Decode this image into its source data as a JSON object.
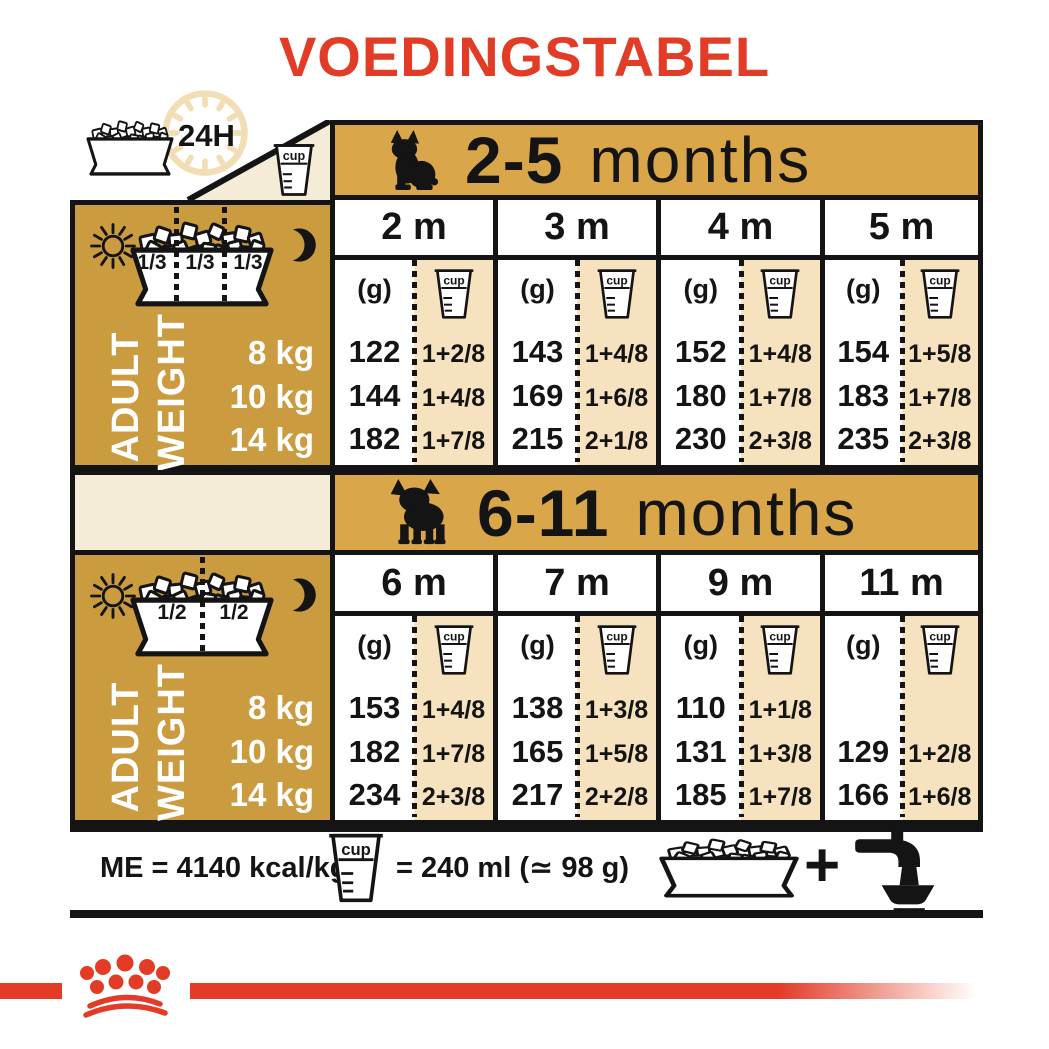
{
  "title": "VOEDINGSTABEL",
  "legend": {
    "hours": "24H"
  },
  "cup_label": "cup",
  "tables": [
    {
      "age": "2-5",
      "months_word": "months",
      "portions": [
        "1/3",
        "1/3",
        "1/3"
      ],
      "weight_label": [
        "ADULT",
        "WEIGHT"
      ],
      "weights": [
        "8 kg",
        "10 kg",
        "14 kg"
      ],
      "unit_g": "(g)",
      "columns": [
        {
          "month": "2 m",
          "grams": [
            "122",
            "144",
            "182"
          ],
          "cups": [
            "1+2/8",
            "1+4/8",
            "1+7/8"
          ]
        },
        {
          "month": "3 m",
          "grams": [
            "143",
            "169",
            "215"
          ],
          "cups": [
            "1+4/8",
            "1+6/8",
            "2+1/8"
          ]
        },
        {
          "month": "4 m",
          "grams": [
            "152",
            "180",
            "230"
          ],
          "cups": [
            "1+4/8",
            "1+7/8",
            "2+3/8"
          ]
        },
        {
          "month": "5 m",
          "grams": [
            "154",
            "183",
            "235"
          ],
          "cups": [
            "1+5/8",
            "1+7/8",
            "2+3/8"
          ]
        }
      ]
    },
    {
      "age": "6-11",
      "months_word": "months",
      "portions": [
        "1/2",
        "1/2"
      ],
      "weight_label": [
        "ADULT",
        "WEIGHT"
      ],
      "weights": [
        "8 kg",
        "10 kg",
        "14 kg"
      ],
      "unit_g": "(g)",
      "columns": [
        {
          "month": "6 m",
          "grams": [
            "153",
            "182",
            "234"
          ],
          "cups": [
            "1+4/8",
            "1+7/8",
            "2+3/8"
          ]
        },
        {
          "month": "7 m",
          "grams": [
            "138",
            "165",
            "217"
          ],
          "cups": [
            "1+3/8",
            "1+5/8",
            "2+2/8"
          ]
        },
        {
          "month": "9 m",
          "grams": [
            "110",
            "131",
            "185"
          ],
          "cups": [
            "1+1/8",
            "1+3/8",
            "1+7/8"
          ]
        },
        {
          "month": "11 m",
          "grams": [
            "",
            "129",
            "166"
          ],
          "cups": [
            "",
            "1+2/8",
            "1+6/8"
          ]
        }
      ]
    }
  ],
  "footer": {
    "me": "ME = 4140 kcal/kg",
    "cup_eq": "= 240 ml (≃ 98 g)",
    "plus": "+"
  },
  "colors": {
    "red": "#E23B26",
    "gold_bar": "#D9A64A",
    "gold_panel": "#CB9B40",
    "tan": "#F6E2BE",
    "cream": "#F5ECD7",
    "clock_beige": "#F2DEB4",
    "ink": "#141414"
  }
}
